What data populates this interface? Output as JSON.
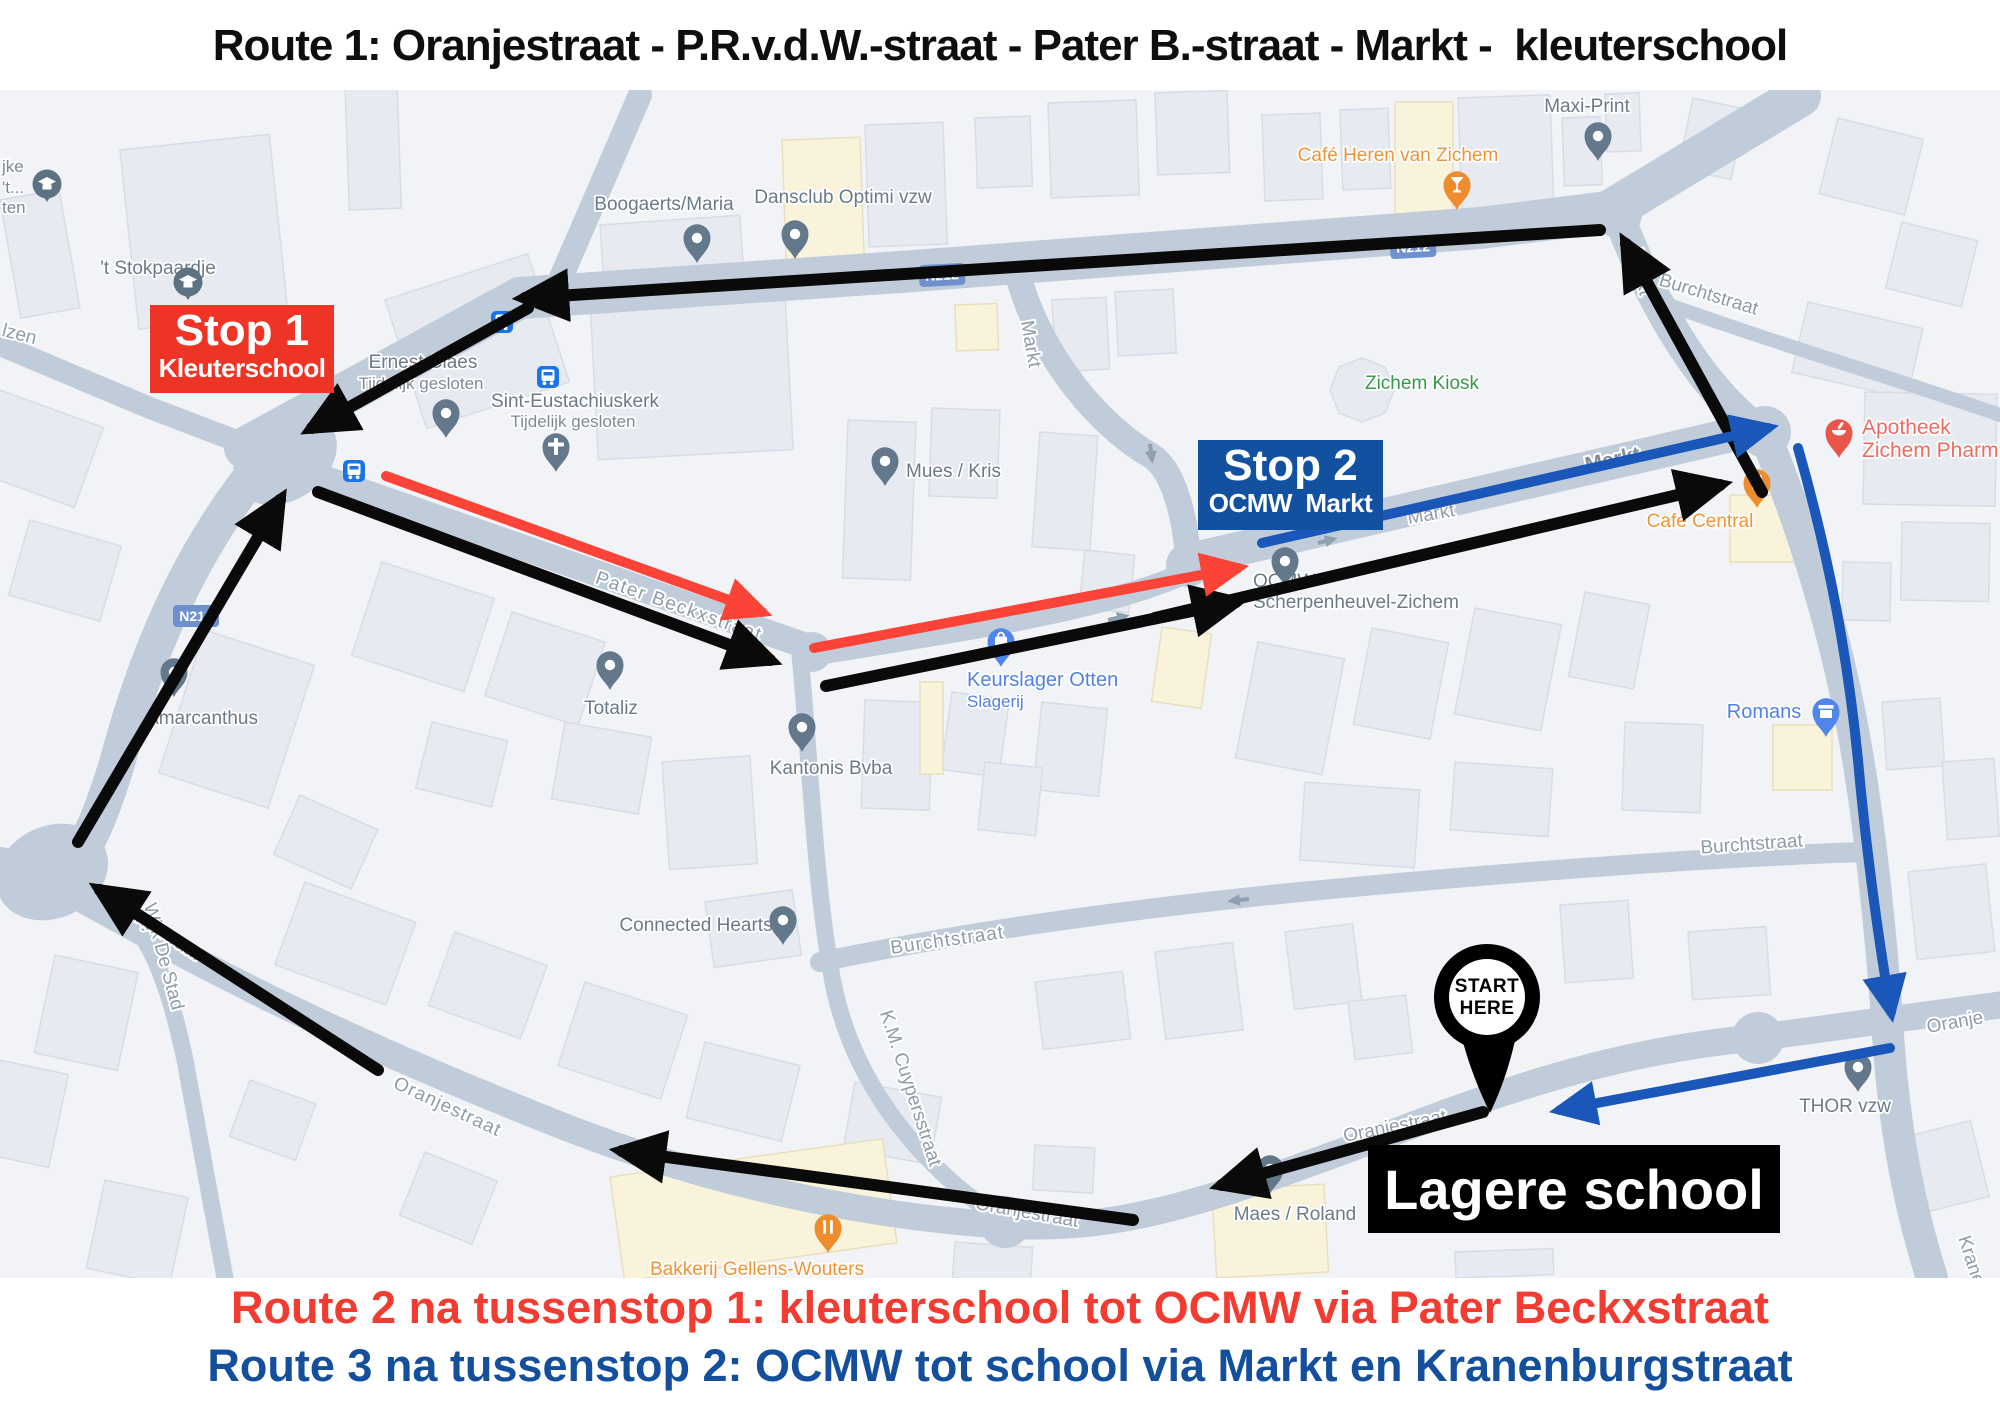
{
  "title": "Route 1: Oranjestraat - P.R.v.d.W.-straat - Pater B.-straat - Markt -  kleuterschool",
  "legend": {
    "route2": "Route 2 na tussenstop 1: kleuterschool tot OCMW via Pater Beckxstraat",
    "route3": "Route 3 na tussenstop 2: OCMW tot school via Markt en Kranenburgstraat"
  },
  "overlays": {
    "stop1": {
      "title": "Stop 1",
      "subtitle": "Kleuterschool"
    },
    "stop2": {
      "title": "Stop 2",
      "subtitle": "OCMW  Markt"
    },
    "school": {
      "label": "Lagere school"
    },
    "start": {
      "line1": "START",
      "line2": "HERE"
    }
  },
  "map": {
    "road_badge": "N212",
    "streets": {
      "markt": "Markt",
      "pater_beckxstraat": "Pater Beckxstraat",
      "burchtstraat": "Burchtstraat",
      "oranjestraat": "Oranjestraat",
      "oranje_partial": "Oranje",
      "wijk_de_stad": "Wijk De Stad",
      "km_cuypersstraat": "K.M. Cuypersstraat",
      "kranenburgstraat": "Kranenburgstraat",
      "lzen_partial": "lzen"
    },
    "pois": {
      "boogaerts": {
        "name": "Boogaerts/Maria"
      },
      "dansclub": {
        "name": "Dansclub Optimi vzw"
      },
      "stokpaardje": {
        "name": "'t Stokpaardje"
      },
      "ernest_claes": {
        "name": "Ernest Claes",
        "status": "Tijdelijk gesloten"
      },
      "sint_eustachiuskerk": {
        "name": "Sint-Eustachiuskerk",
        "status": "Tijdelijk gesloten"
      },
      "mues_kris": {
        "name": "Mues / Kris"
      },
      "zichem_kiosk": {
        "name": "Zichem Kiosk"
      },
      "cafe_heren": {
        "name": "Café Heren van Zichem"
      },
      "maxi_print": {
        "name": "Maxi-Print"
      },
      "apotheek": {
        "line1": "Apotheek",
        "line2": "Zichem Pharm"
      },
      "cafe_central": {
        "name": "Café Central"
      },
      "romans": {
        "name": "Romans"
      },
      "keurslager": {
        "name": "Keurslager Otten",
        "sub": "Slagerij"
      },
      "ocmw": {
        "line1": "OCMW",
        "line2": "Scherpenheuvel-Zichem"
      },
      "totaliz": {
        "name": "Totaliz"
      },
      "kantonis": {
        "name": "Kantonis Bvba"
      },
      "connected_hearts": {
        "name": "Connected Hearts"
      },
      "maes_roland": {
        "name": "Maes / Roland"
      },
      "thor": {
        "name": "THOR vzw"
      },
      "bakkerij": {
        "name": "Bakkerij Gellens-Wouters"
      },
      "amarcanthus": {
        "name": "Amarcanthus"
      }
    },
    "edge_labels": {
      "l1": "jke",
      "l2": "'t...",
      "l3": "ten"
    }
  },
  "colors": {
    "route1": "#0a0a0a",
    "route2": "#fb4337",
    "route3": "#1a57b8",
    "stop1_bg": "#ee3425",
    "stop2_bg": "#11519f",
    "school_bg": "#000000",
    "legend_red": "#f23b31",
    "legend_blue": "#134f9d",
    "road": "#c0ccda"
  }
}
